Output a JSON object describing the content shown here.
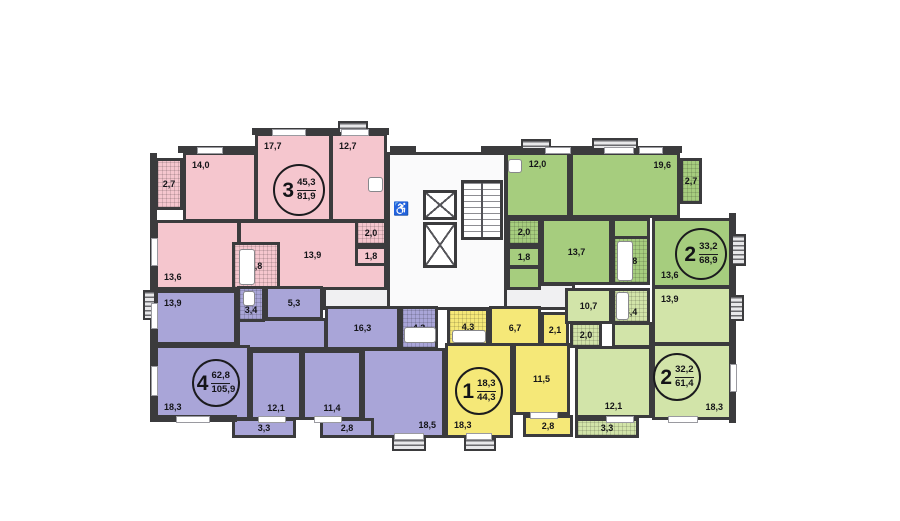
{
  "plan": {
    "canvas": {
      "w": 900,
      "h": 521,
      "bg": "#ffffff"
    },
    "colors": {
      "wall": "#3b3b3d",
      "corridor_light": "#fafafb",
      "corridor_gray": "#f0f0f2",
      "pink": "#f5c6ce",
      "purple": "#a9a5d8",
      "yellow": "#f5e878",
      "green": "#a6cd7e",
      "lightgreen": "#d2e4a9"
    },
    "apartments": [
      {
        "id": "apartment-3-room-pink",
        "color_key": "pink",
        "badge": {
          "type": "3",
          "upper": "45,3",
          "lower": "81,9",
          "cx": 299,
          "cy": 190,
          "r": 26
        },
        "rooms": [
          {
            "label": "2,7",
            "x": 155,
            "y": 158,
            "w": 28,
            "h": 52,
            "hatch": true,
            "anchor": "c"
          },
          {
            "label": "14,0",
            "x": 183,
            "y": 152,
            "w": 74,
            "h": 70,
            "hatch": false,
            "anchor": "tl"
          },
          {
            "label": "17,7",
            "x": 255,
            "y": 133,
            "w": 77,
            "h": 89,
            "hatch": false,
            "anchor": "tl"
          },
          {
            "label": "12,7",
            "x": 330,
            "y": 133,
            "w": 57,
            "h": 89,
            "hatch": false,
            "anchor": "tl"
          },
          {
            "label": "13,6",
            "x": 155,
            "y": 220,
            "w": 85,
            "h": 70,
            "hatch": false,
            "anchor": "bl"
          },
          {
            "label": "13,9",
            "x": 238,
            "y": 220,
            "w": 149,
            "h": 70,
            "hatch": false,
            "anchor": "c"
          },
          {
            "label": "4,8",
            "x": 232,
            "y": 242,
            "w": 48,
            "h": 48,
            "hatch": true,
            "anchor": "c"
          },
          {
            "label": "2,0",
            "x": 355,
            "y": 220,
            "w": 32,
            "h": 26,
            "hatch": true,
            "anchor": "c"
          },
          {
            "label": "1,8",
            "x": 355,
            "y": 246,
            "w": 32,
            "h": 20,
            "hatch": false,
            "anchor": "c"
          }
        ]
      },
      {
        "id": "apartment-4-room-purple",
        "color_key": "purple",
        "badge": {
          "type": "4",
          "upper": "62,8",
          "lower": "105,9",
          "cx": 216,
          "cy": 383,
          "r": 24
        },
        "rooms": [
          {
            "label": "13,9",
            "x": 155,
            "y": 290,
            "w": 82,
            "h": 55,
            "hatch": false,
            "anchor": "tl"
          },
          {
            "label": "",
            "x": 237,
            "y": 318,
            "w": 90,
            "h": 32,
            "hatch": false,
            "anchor": "c"
          },
          {
            "label": "3,4",
            "x": 237,
            "y": 286,
            "w": 28,
            "h": 36,
            "hatch": true,
            "anchor": "b"
          },
          {
            "label": "5,3",
            "x": 265,
            "y": 286,
            "w": 58,
            "h": 34,
            "hatch": false,
            "anchor": "c"
          },
          {
            "label": "16,3",
            "x": 325,
            "y": 306,
            "w": 75,
            "h": 44,
            "hatch": false,
            "anchor": "c"
          },
          {
            "label": "4,3",
            "x": 400,
            "y": 306,
            "w": 38,
            "h": 44,
            "hatch": true,
            "anchor": "c"
          },
          {
            "label": "18,3",
            "x": 155,
            "y": 345,
            "w": 95,
            "h": 75,
            "hatch": false,
            "anchor": "bl"
          },
          {
            "label": "12,1",
            "x": 250,
            "y": 350,
            "w": 52,
            "h": 70,
            "hatch": false,
            "anchor": "b"
          },
          {
            "label": "11,4",
            "x": 302,
            "y": 350,
            "w": 60,
            "h": 70,
            "hatch": false,
            "anchor": "b"
          },
          {
            "label": "18,5",
            "x": 362,
            "y": 348,
            "w": 83,
            "h": 90,
            "hatch": false,
            "anchor": "br"
          },
          {
            "label": "3,3",
            "x": 232,
            "y": 418,
            "w": 64,
            "h": 20,
            "hatch": false,
            "anchor": "c"
          },
          {
            "label": "2,8",
            "x": 320,
            "y": 418,
            "w": 54,
            "h": 20,
            "hatch": false,
            "anchor": "c"
          }
        ]
      },
      {
        "id": "apartment-1-room-yellow",
        "color_key": "yellow",
        "badge": {
          "type": "1",
          "upper": "18,3",
          "lower": "44,3",
          "cx": 479,
          "cy": 391,
          "r": 24
        },
        "rooms": [
          {
            "label": "4,3",
            "x": 447,
            "y": 308,
            "w": 42,
            "h": 38,
            "hatch": true,
            "anchor": "c"
          },
          {
            "label": "6,7",
            "x": 489,
            "y": 306,
            "w": 52,
            "h": 44,
            "hatch": false,
            "anchor": "c"
          },
          {
            "label": "2,1",
            "x": 541,
            "y": 312,
            "w": 28,
            "h": 36,
            "hatch": false,
            "anchor": "c"
          },
          {
            "label": "18,3",
            "x": 445,
            "y": 343,
            "w": 68,
            "h": 95,
            "hatch": false,
            "anchor": "bl"
          },
          {
            "label": "11,5",
            "x": 513,
            "y": 343,
            "w": 57,
            "h": 72,
            "hatch": false,
            "anchor": "c"
          },
          {
            "label": "2,8",
            "x": 523,
            "y": 415,
            "w": 50,
            "h": 22,
            "hatch": false,
            "anchor": "c"
          }
        ]
      },
      {
        "id": "apartment-2-room-green",
        "color_key": "green",
        "badge": {
          "type": "2",
          "upper": "33,2",
          "lower": "68,9",
          "cx": 701,
          "cy": 254,
          "r": 26
        },
        "rooms": [
          {
            "label": "12,0",
            "x": 505,
            "y": 152,
            "w": 65,
            "h": 66,
            "hatch": false,
            "anchor": "t"
          },
          {
            "label": "19,6",
            "x": 570,
            "y": 152,
            "w": 110,
            "h": 66,
            "hatch": false,
            "anchor": "tr"
          },
          {
            "label": "2,7",
            "x": 680,
            "y": 158,
            "w": 22,
            "h": 46,
            "hatch": true,
            "anchor": "c"
          },
          {
            "label": "",
            "x": 507,
            "y": 266,
            "w": 34,
            "h": 24,
            "hatch": false,
            "anchor": "c"
          },
          {
            "label": "2,0",
            "x": 507,
            "y": 218,
            "w": 34,
            "h": 28,
            "hatch": true,
            "anchor": "c"
          },
          {
            "label": "1,8",
            "x": 507,
            "y": 246,
            "w": 34,
            "h": 22,
            "hatch": false,
            "anchor": "c"
          },
          {
            "label": "13,7",
            "x": 541,
            "y": 218,
            "w": 71,
            "h": 67,
            "hatch": false,
            "anchor": "c"
          },
          {
            "label": "",
            "x": 612,
            "y": 218,
            "w": 38,
            "h": 22,
            "hatch": false,
            "anchor": "c"
          },
          {
            "label": "4,8",
            "x": 612,
            "y": 236,
            "w": 38,
            "h": 49,
            "hatch": true,
            "anchor": "c"
          },
          {
            "label": "13,6",
            "x": 652,
            "y": 218,
            "w": 80,
            "h": 70,
            "hatch": false,
            "anchor": "bl"
          }
        ]
      },
      {
        "id": "apartment-2-room-lightgreen",
        "color_key": "lightgreen",
        "badge": {
          "type": "2",
          "upper": "32,2",
          "lower": "61,4",
          "cx": 677,
          "cy": 377,
          "r": 24
        },
        "rooms": [
          {
            "label": "10,7",
            "x": 565,
            "y": 288,
            "w": 47,
            "h": 36,
            "hatch": false,
            "anchor": "c"
          },
          {
            "label": "2,0",
            "x": 570,
            "y": 322,
            "w": 32,
            "h": 26,
            "hatch": true,
            "anchor": "c"
          },
          {
            "label": "3,4",
            "x": 612,
            "y": 288,
            "w": 38,
            "h": 36,
            "hatch": true,
            "anchor": "b"
          },
          {
            "label": "",
            "x": 612,
            "y": 322,
            "w": 40,
            "h": 26,
            "hatch": false,
            "anchor": "c"
          },
          {
            "label": "13,9",
            "x": 652,
            "y": 286,
            "w": 80,
            "h": 59,
            "hatch": false,
            "anchor": "tl"
          },
          {
            "label": "12,1",
            "x": 575,
            "y": 346,
            "w": 77,
            "h": 72,
            "hatch": false,
            "anchor": "b"
          },
          {
            "label": "18,3",
            "x": 652,
            "y": 343,
            "w": 80,
            "h": 77,
            "hatch": false,
            "anchor": "br"
          },
          {
            "label": "3,3",
            "x": 575,
            "y": 418,
            "w": 64,
            "h": 20,
            "hatch": true,
            "anchor": "c"
          }
        ]
      }
    ],
    "core": {
      "corridors": [
        {
          "x": 323,
          "y": 283,
          "w": 252,
          "h": 27,
          "shade": "gray"
        },
        {
          "x": 387,
          "y": 152,
          "w": 120,
          "h": 158,
          "shade": "light"
        }
      ],
      "elevators": [
        {
          "x": 423,
          "y": 190,
          "w": 34,
          "h": 30
        },
        {
          "x": 423,
          "y": 222,
          "w": 34,
          "h": 46
        }
      ],
      "stairs": {
        "x": 461,
        "y": 180,
        "w": 42,
        "h": 60
      },
      "wheelchair": {
        "glyph": "♿",
        "x": 393,
        "y": 202
      }
    },
    "walls": [
      {
        "x": 252,
        "y": 128,
        "w": 137,
        "h": 7
      },
      {
        "x": 178,
        "y": 146,
        "w": 79,
        "h": 7
      },
      {
        "x": 505,
        "y": 146,
        "w": 177,
        "h": 7
      },
      {
        "x": 390,
        "y": 146,
        "w": 26,
        "h": 7
      },
      {
        "x": 481,
        "y": 146,
        "w": 26,
        "h": 7
      },
      {
        "x": 150,
        "y": 153,
        "w": 7,
        "h": 140
      },
      {
        "x": 150,
        "y": 288,
        "w": 7,
        "h": 134
      },
      {
        "x": 150,
        "y": 415,
        "w": 87,
        "h": 7
      },
      {
        "x": 729,
        "y": 213,
        "w": 7,
        "h": 210
      }
    ],
    "windows": [
      {
        "x": 272,
        "y": 129,
        "w": 34,
        "h": 7
      },
      {
        "x": 341,
        "y": 129,
        "w": 28,
        "h": 7
      },
      {
        "x": 197,
        "y": 147,
        "w": 26,
        "h": 7
      },
      {
        "x": 545,
        "y": 147,
        "w": 26,
        "h": 7
      },
      {
        "x": 604,
        "y": 147,
        "w": 30,
        "h": 7
      },
      {
        "x": 639,
        "y": 147,
        "w": 24,
        "h": 7
      },
      {
        "x": 151,
        "y": 238,
        "w": 7,
        "h": 28
      },
      {
        "x": 151,
        "y": 303,
        "w": 7,
        "h": 26
      },
      {
        "x": 151,
        "y": 366,
        "w": 7,
        "h": 30
      },
      {
        "x": 176,
        "y": 416,
        "w": 34,
        "h": 7
      },
      {
        "x": 258,
        "y": 416,
        "w": 28,
        "h": 7
      },
      {
        "x": 314,
        "y": 416,
        "w": 28,
        "h": 7
      },
      {
        "x": 394,
        "y": 433,
        "w": 30,
        "h": 7
      },
      {
        "x": 466,
        "y": 433,
        "w": 26,
        "h": 7
      },
      {
        "x": 530,
        "y": 412,
        "w": 28,
        "h": 7
      },
      {
        "x": 606,
        "y": 416,
        "w": 28,
        "h": 7
      },
      {
        "x": 668,
        "y": 416,
        "w": 30,
        "h": 7
      },
      {
        "x": 730,
        "y": 364,
        "w": 7,
        "h": 28
      }
    ],
    "vents": [
      {
        "x": 338,
        "y": 121,
        "w": 30,
        "h": 13
      },
      {
        "x": 521,
        "y": 139,
        "w": 30,
        "h": 11
      },
      {
        "x": 592,
        "y": 138,
        "w": 46,
        "h": 12
      },
      {
        "x": 731,
        "y": 234,
        "w": 15,
        "h": 32
      },
      {
        "x": 729,
        "y": 295,
        "w": 15,
        "h": 26
      },
      {
        "x": 143,
        "y": 290,
        "w": 13,
        "h": 30
      },
      {
        "x": 392,
        "y": 438,
        "w": 34,
        "h": 13
      },
      {
        "x": 464,
        "y": 438,
        "w": 32,
        "h": 13
      }
    ],
    "fixtures": [
      {
        "name": "bathtub",
        "x": 239,
        "y": 249,
        "w": 16,
        "h": 36
      },
      {
        "name": "bathtub",
        "x": 617,
        "y": 241,
        "w": 16,
        "h": 40
      },
      {
        "name": "bathtub",
        "x": 404,
        "y": 327,
        "w": 32,
        "h": 16
      },
      {
        "name": "bathtub",
        "x": 452,
        "y": 330,
        "w": 34,
        "h": 13
      },
      {
        "name": "bathtub",
        "x": 616,
        "y": 292,
        "w": 13,
        "h": 28
      },
      {
        "name": "toilet",
        "x": 243,
        "y": 291,
        "w": 12,
        "h": 15
      },
      {
        "name": "stove",
        "x": 368,
        "y": 177,
        "w": 15,
        "h": 15
      },
      {
        "name": "stove",
        "x": 508,
        "y": 159,
        "w": 14,
        "h": 14
      }
    ]
  }
}
